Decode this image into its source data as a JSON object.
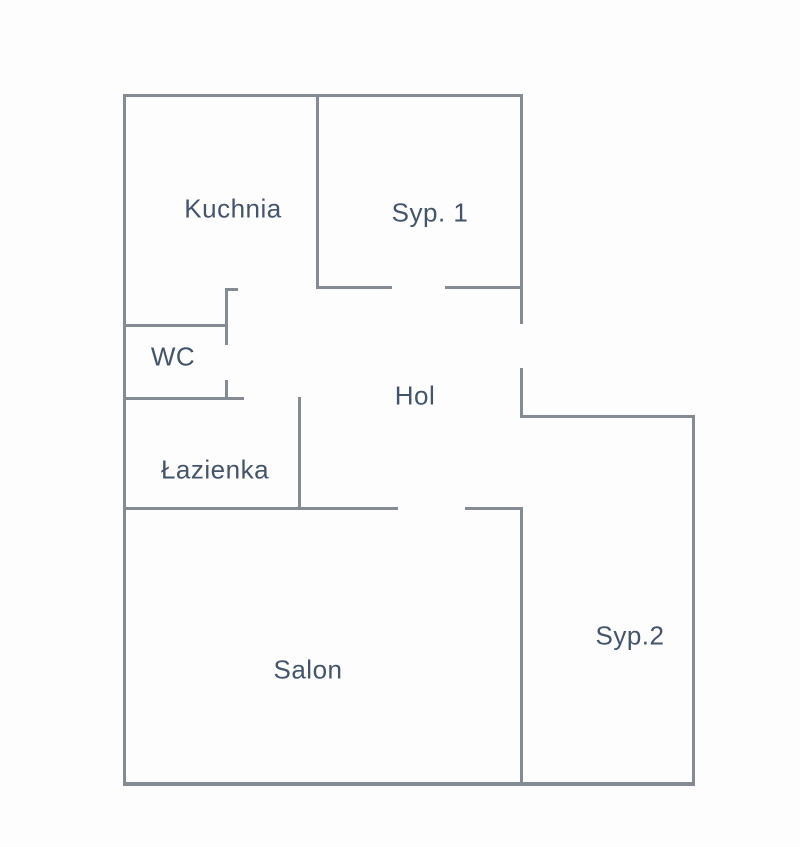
{
  "title": "Apartment floor plan",
  "colors": {
    "wall": "#858B92",
    "text": "#44546A",
    "background": "#FDFDFE"
  },
  "floor_plan": {
    "width": 800,
    "height": 847,
    "rooms": [
      {
        "id": "kuchnia",
        "label": "Kuchnia",
        "x": 233,
        "y": 209
      },
      {
        "id": "syp1",
        "label": "Syp. 1",
        "x": 430,
        "y": 213
      },
      {
        "id": "wc",
        "label": "WC",
        "x": 173,
        "y": 357
      },
      {
        "id": "hol",
        "label": "Hol",
        "x": 415,
        "y": 396
      },
      {
        "id": "lazienka",
        "label": "Łazienka",
        "x": 215,
        "y": 470
      },
      {
        "id": "salon",
        "label": "Salon",
        "x": 308,
        "y": 670
      },
      {
        "id": "syp2",
        "label": "Syp.2",
        "x": 630,
        "y": 636
      }
    ],
    "walls": [
      {
        "name": "outer-top-wall",
        "x": 123,
        "y": 94,
        "w": 400,
        "h": 3
      },
      {
        "name": "outer-left-wall",
        "x": 123,
        "y": 94,
        "w": 3,
        "h": 691
      },
      {
        "name": "outer-bottom-wall",
        "x": 123,
        "y": 782,
        "w": 572,
        "h": 4
      },
      {
        "name": "right-wall-upper",
        "x": 520,
        "y": 94,
        "w": 3,
        "h": 230
      },
      {
        "name": "right-wall-hol-stub",
        "x": 520,
        "y": 368,
        "w": 3,
        "h": 50
      },
      {
        "name": "syp2-top-wall",
        "x": 520,
        "y": 415,
        "w": 175,
        "h": 3
      },
      {
        "name": "outer-right-wall-syp2",
        "x": 692,
        "y": 415,
        "w": 3,
        "h": 371
      },
      {
        "name": "kuchnia-syp1-wall",
        "x": 316,
        "y": 94,
        "w": 3,
        "h": 194
      },
      {
        "name": "syp1-bottom-wall-left",
        "x": 316,
        "y": 286,
        "w": 76,
        "h": 3
      },
      {
        "name": "syp1-bottom-wall-right",
        "x": 445,
        "y": 286,
        "w": 78,
        "h": 3
      },
      {
        "name": "kuchnia-entry-wall",
        "x": 225,
        "y": 289,
        "w": 3,
        "h": 56
      },
      {
        "name": "kuchnia-entry-cap",
        "x": 225,
        "y": 288,
        "w": 13,
        "h": 3
      },
      {
        "name": "wc-top-wall",
        "x": 123,
        "y": 324,
        "w": 105,
        "h": 3
      },
      {
        "name": "wc-door-stub",
        "x": 225,
        "y": 380,
        "w": 3,
        "h": 19
      },
      {
        "name": "wc-bottom-wall",
        "x": 123,
        "y": 397,
        "w": 121,
        "h": 3
      },
      {
        "name": "lazienka-right-wall",
        "x": 298,
        "y": 397,
        "w": 3,
        "h": 113
      },
      {
        "name": "salon-top-wall-left",
        "x": 123,
        "y": 507,
        "w": 275,
        "h": 3
      },
      {
        "name": "salon-top-wall-right",
        "x": 465,
        "y": 507,
        "w": 58,
        "h": 3
      },
      {
        "name": "salon-syp2-wall",
        "x": 520,
        "y": 507,
        "w": 3,
        "h": 278
      }
    ]
  }
}
